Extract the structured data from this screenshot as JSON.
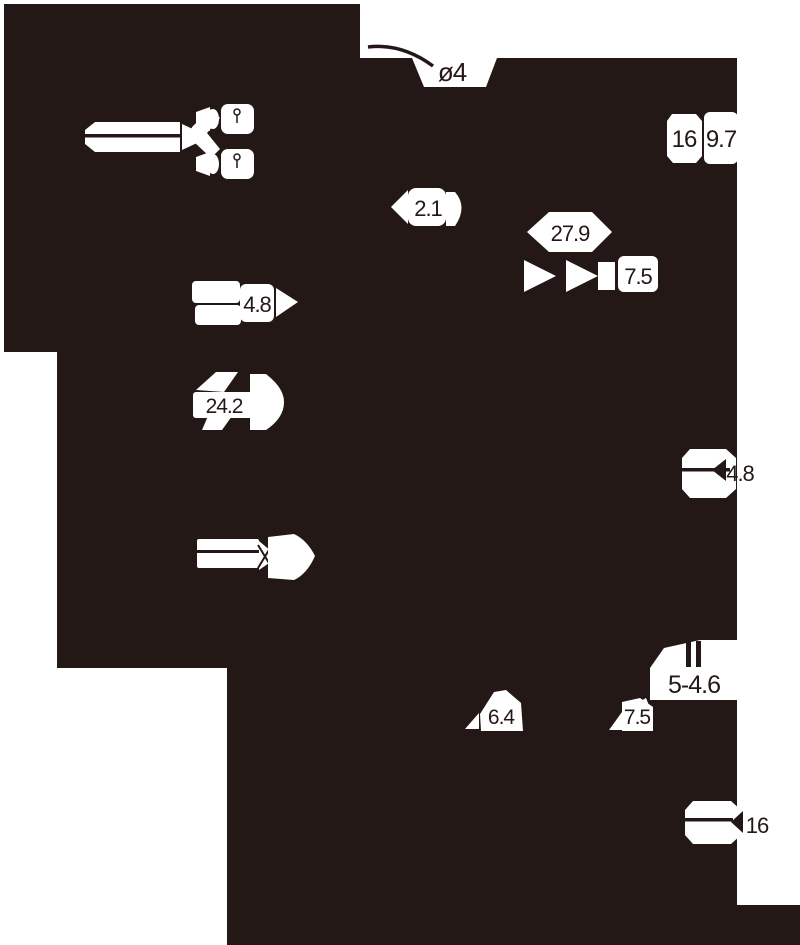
{
  "canvas": {
    "width": 800,
    "height": 945
  },
  "colors": {
    "ink": "#231815",
    "paper": "#ffffff"
  },
  "labels": {
    "plug_diameter": "ø4",
    "top_right_width": "16",
    "top_right_depth": "9.7",
    "cord_width": "2.1",
    "body_length": "27.9",
    "body_height": "7.5",
    "left_width": "4.8",
    "left_length": "24.2",
    "right_width": "4.8",
    "hole_spec": "5-4.6",
    "bottom_width": "6.4",
    "bottom_height": "7.5",
    "bottom_right_width": "16"
  }
}
